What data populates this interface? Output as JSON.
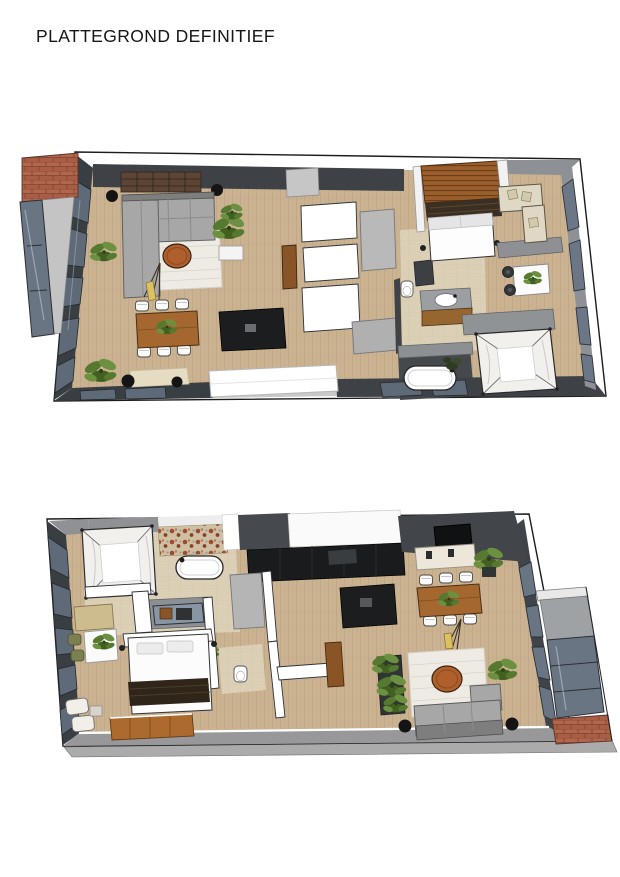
{
  "document": {
    "title": "PLATTEGROND DEFINITIEF",
    "background": "#ffffff"
  },
  "floorplans": [
    {
      "id": "plan-1",
      "position": "top"
    },
    {
      "id": "plan-2",
      "position": "bottom"
    }
  ],
  "palette": {
    "floor_wood": "#cbb392",
    "floor_tile": "#dbcfb6",
    "floor_dark_tile": "#45484c",
    "wall_dark": "#3e4247",
    "wall_grey": "#8f9194",
    "wall_white": "#ffffff",
    "window_glass": "#6a7584",
    "brick": "#b2664c",
    "sofa_grey": "#a7a7a7",
    "sofa_cream": "#dfd8c4",
    "rug_white": "#edebe4",
    "wood_furniture": "#a3672f",
    "kitchen_island": "#1b1d1f",
    "plant_green": "#55792f",
    "accent_terracotta": "#ae5f2c",
    "lamp_yellow": "#d9c25f"
  }
}
